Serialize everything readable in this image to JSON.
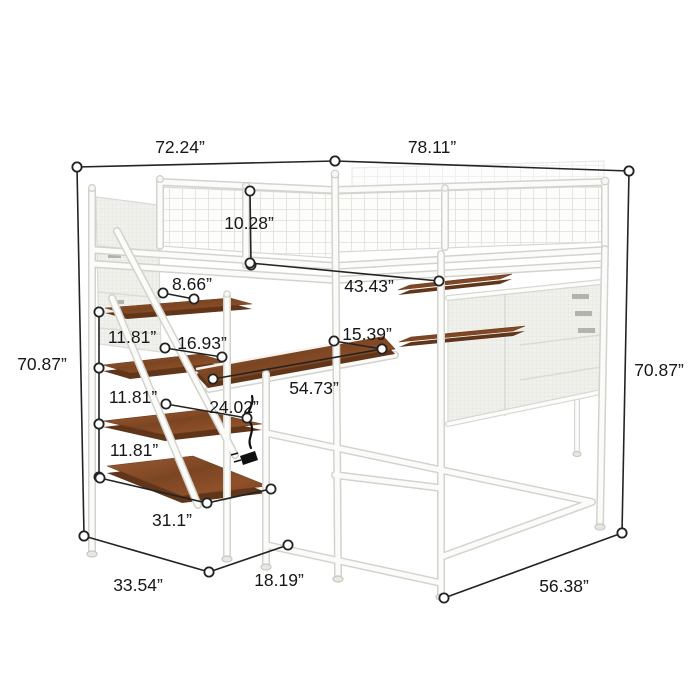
{
  "figure": {
    "subject": "Dimension diagram of a white metal loft bed with storage staircase, desk, hanging shelves and mesh side pockets",
    "unit": "inches"
  },
  "colors": {
    "background": "#ffffff",
    "frame_white": "#fbfbf9",
    "frame_outline": "#d3d3cd",
    "wood": "#8a5129",
    "wood_edge": "#613519",
    "fabric_panel": "#f0f0ec",
    "dimension_line": "#232323",
    "label_text": "#171717"
  },
  "dimensions": [
    {
      "id": "bed-width-top-left",
      "label": "72.24”",
      "label_x": 180,
      "label_y": 153,
      "points": [
        [
          77,
          167
        ],
        [
          335,
          161
        ]
      ]
    },
    {
      "id": "bed-length-top-right",
      "label": "78.11”",
      "label_x": 432,
      "label_y": 153,
      "points": [
        [
          335,
          161
        ],
        [
          629,
          171
        ]
      ]
    },
    {
      "id": "overall-height-left",
      "label": "70.87”",
      "label_x": 42,
      "label_y": 370,
      "points": [
        [
          77,
          167
        ],
        [
          84,
          536
        ]
      ]
    },
    {
      "id": "overall-height-right",
      "label": "70.87”",
      "label_x": 659,
      "label_y": 376,
      "points": [
        [
          629,
          171
        ],
        [
          622,
          533
        ]
      ]
    },
    {
      "id": "guardrail-height",
      "label": "10.28”",
      "label_x": 249,
      "label_y": 229,
      "points": [
        [
          250,
          191
        ],
        [
          251,
          265
        ]
      ]
    },
    {
      "id": "top-shelf-depth",
      "label": "8.66”",
      "label_x": 192,
      "label_y": 290,
      "points": [
        [
          163,
          293
        ],
        [
          194,
          299
        ]
      ]
    },
    {
      "id": "under-bed-clearance",
      "label": "43.43”",
      "label_x": 369,
      "label_y": 292,
      "points": [
        [
          250,
          263
        ],
        [
          439,
          281
        ]
      ]
    },
    {
      "id": "shelf-2-width",
      "label": "16.93”",
      "label_x": 202,
      "label_y": 349,
      "points": [
        [
          165,
          348
        ],
        [
          222,
          357
        ]
      ]
    },
    {
      "id": "hanging-shelf-gap",
      "label": "15.39”",
      "label_x": 367,
      "label_y": 340,
      "points": [
        [
          334,
          341
        ],
        [
          382,
          349
        ]
      ]
    },
    {
      "id": "desk-length",
      "label": "54.73”",
      "label_x": 314,
      "label_y": 394,
      "points": [
        [
          213,
          379
        ],
        [
          382,
          349
        ]
      ]
    },
    {
      "id": "shelf-3-width",
      "label": "24.02”",
      "label_x": 234,
      "label_y": 413,
      "points": [
        [
          166,
          404
        ],
        [
          247,
          418
        ]
      ]
    },
    {
      "id": "shelf-spacing-upper",
      "label": "11.81”",
      "label_x": 132,
      "label_y": 343,
      "points": [
        [
          99,
          312
        ],
        [
          99,
          368
        ]
      ]
    },
    {
      "id": "shelf-spacing-middle",
      "label": "11.81”",
      "label_x": 133,
      "label_y": 403,
      "points": [
        [
          99,
          368
        ],
        [
          99,
          424
        ]
      ]
    },
    {
      "id": "shelf-spacing-lower",
      "label": "11.81”",
      "label_x": 134,
      "label_y": 456,
      "points": [
        [
          99,
          424
        ],
        [
          99,
          477
        ]
      ]
    },
    {
      "id": "bottom-shelf-width",
      "label": "31.1”",
      "label_x": 172,
      "label_y": 526,
      "points": [
        [
          100,
          478
        ],
        [
          207,
          503
        ],
        [
          271,
          489
        ]
      ]
    },
    {
      "id": "floor-depth-left",
      "label": "33.54”",
      "label_x": 138,
      "label_y": 591,
      "points": [
        [
          84,
          536
        ],
        [
          209,
          572
        ]
      ]
    },
    {
      "id": "floor-stair-depth",
      "label": "18.19”",
      "label_x": 279,
      "label_y": 586,
      "points": [
        [
          209,
          572
        ],
        [
          288,
          545
        ]
      ]
    },
    {
      "id": "floor-length-right",
      "label": "56.38”",
      "label_x": 564,
      "label_y": 592,
      "points": [
        [
          444,
          598
        ],
        [
          622,
          533
        ]
      ]
    }
  ]
}
